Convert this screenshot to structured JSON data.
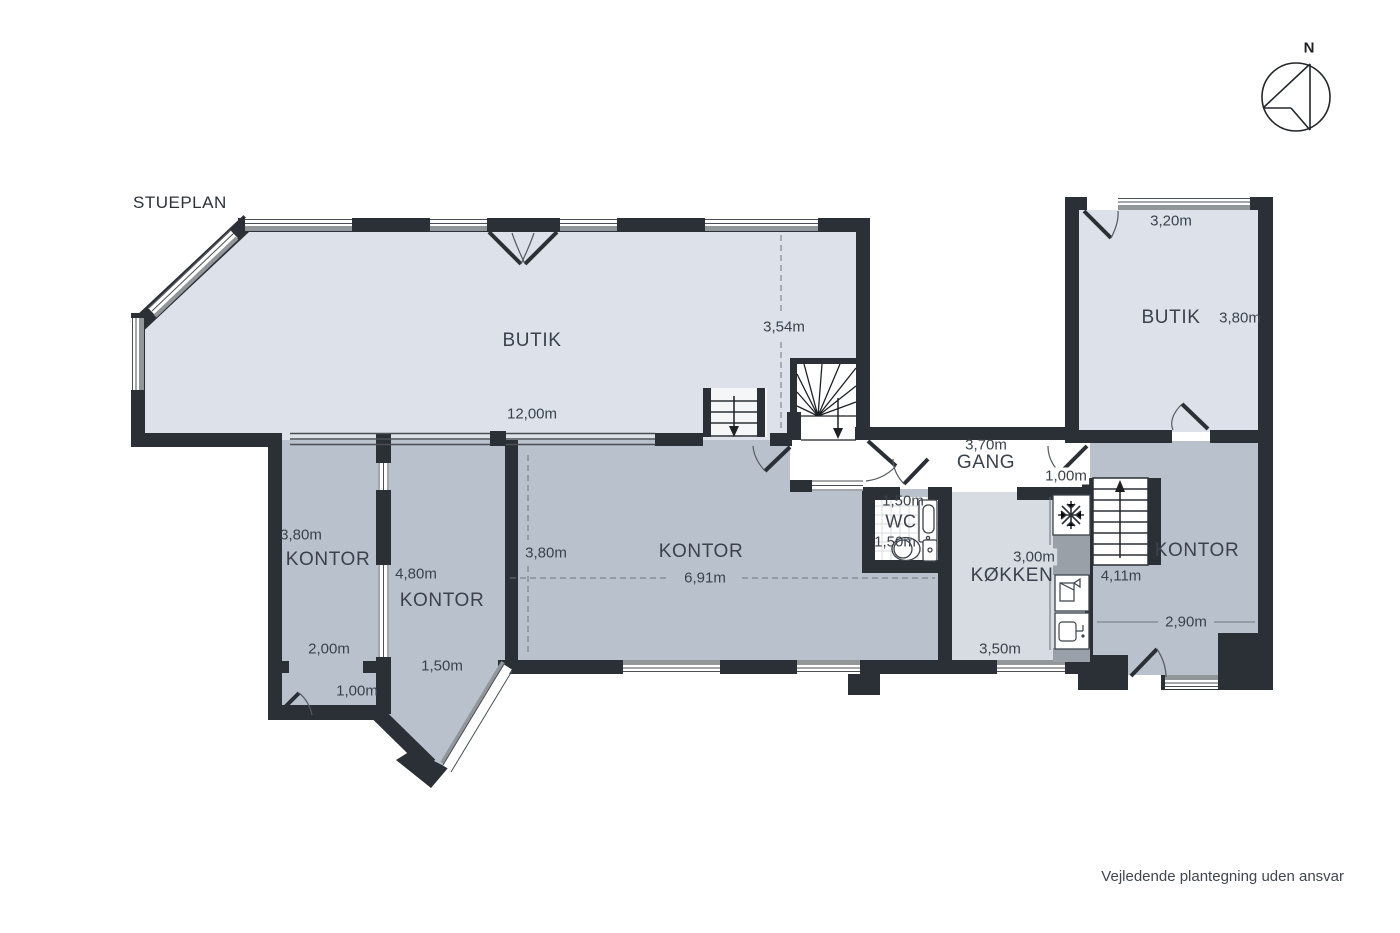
{
  "title": "STUEPLAN",
  "disclaimer": "Vejledende plantegning uden ansvar",
  "compass": {
    "label": "N"
  },
  "colors": {
    "wall": "#2b3036",
    "butik_fill": "#dde2ea",
    "kontor_fill": "#b9c1cc",
    "kokken_fill": "#d7dce3",
    "gang_fill": "#ffffff",
    "window_gray": "#919699",
    "text": "#3b424c"
  },
  "rooms": {
    "butik_main": {
      "label": "BUTIK",
      "dim_width": "12,00m",
      "dim_height": "3,54m"
    },
    "butik_right": {
      "label": "BUTIK",
      "dim_top": "3,20m",
      "dim_right": "3,80m"
    },
    "gang": {
      "label": "GANG",
      "dim_width": "3,70m",
      "dim_door": "1,00m"
    },
    "wc": {
      "label": "WC",
      "dim_top": "1,50m",
      "dim_bottom": "1,50m"
    },
    "kokken": {
      "label": "KØKKEN",
      "dim_height": "3,00m",
      "dim_width": "3,50m"
    },
    "kontor_left": {
      "label": "KONTOR",
      "dim_height": "3,80m",
      "dim_width": "2,00m",
      "dim_door": "1,00m"
    },
    "kontor_mid": {
      "label": "KONTOR",
      "dim_height": "4,80m",
      "dim_width": "1,50m"
    },
    "kontor_main": {
      "label": "KONTOR",
      "dim_height": "3,80m",
      "dim_width": "6,91m"
    },
    "kontor_right": {
      "label": "KONTOR",
      "dim_stairs": "4,11m",
      "dim_width": "2,90m"
    }
  }
}
